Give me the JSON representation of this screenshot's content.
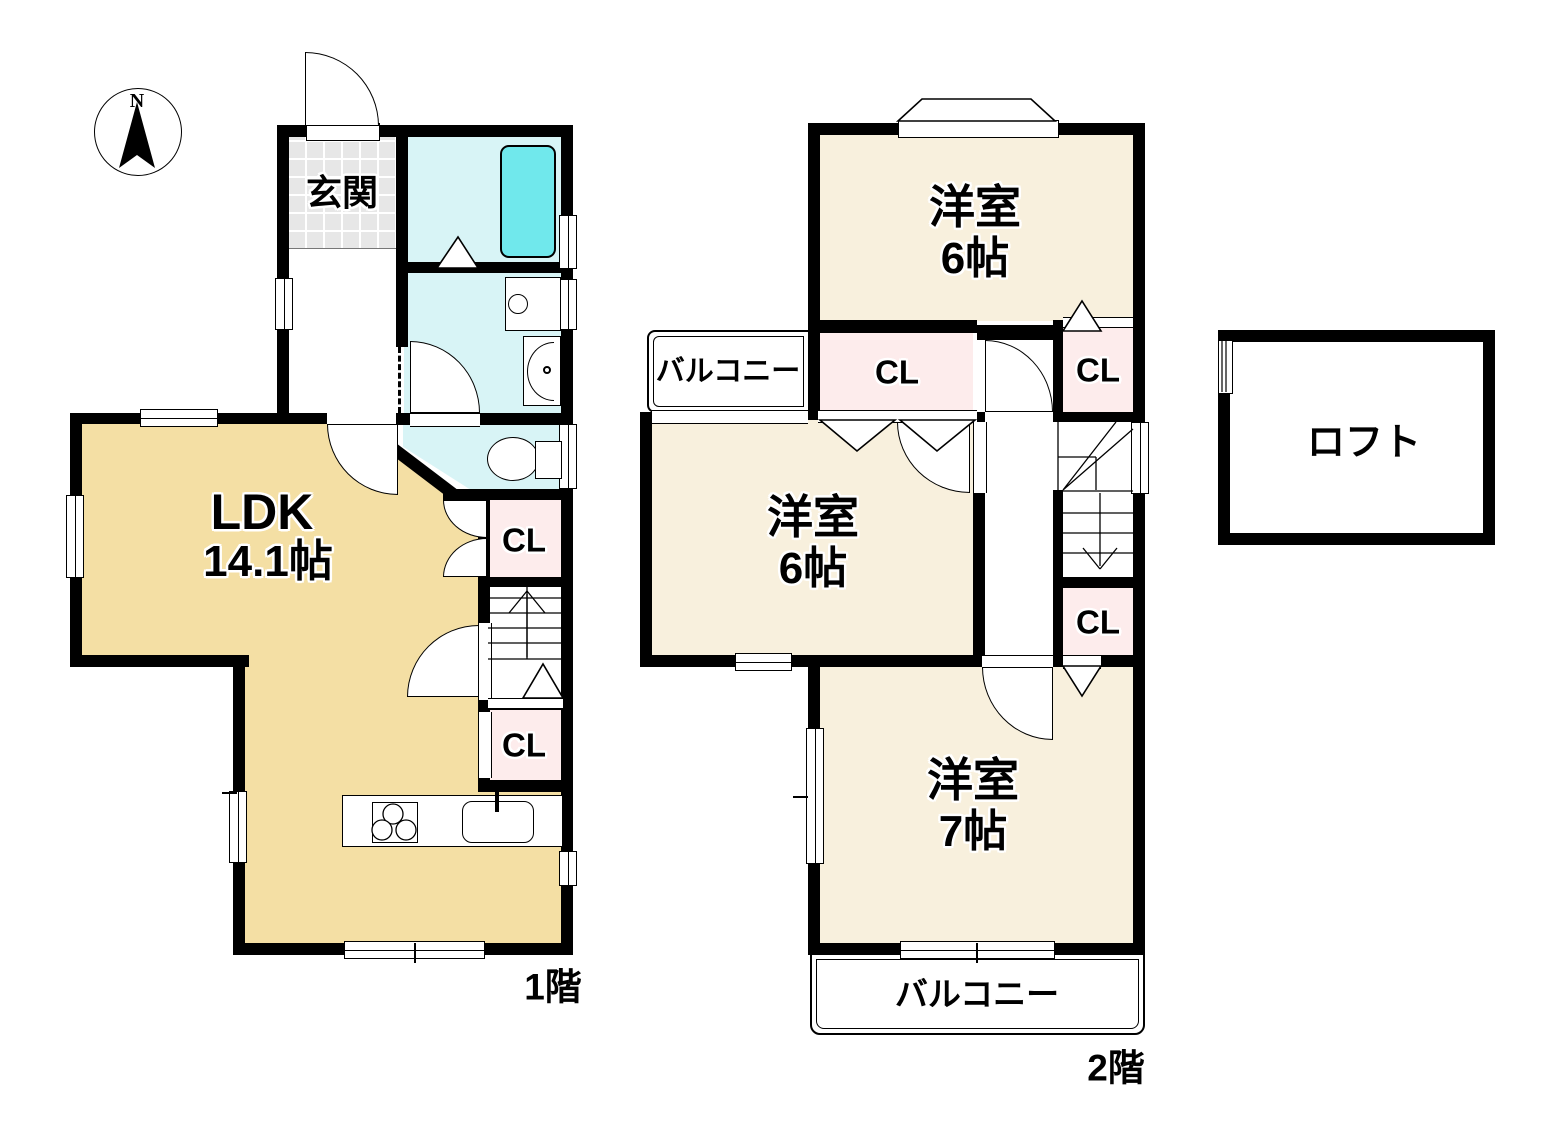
{
  "compass": {
    "north_label": "N"
  },
  "floor1": {
    "floor_label": "1階",
    "genkan_label": "玄関",
    "ldk_label": "LDK",
    "ldk_size": "14.1帖",
    "closet_upper": "CL",
    "closet_lower": "CL"
  },
  "floor2": {
    "floor_label": "2階",
    "room_north_label": "洋室",
    "room_north_size": "6帖",
    "room_middle_label": "洋室",
    "room_middle_size": "6帖",
    "room_south_label": "洋室",
    "room_south_size": "7帖",
    "closet_west": "CL",
    "closet_east_upper": "CL",
    "closet_east_lower": "CL",
    "balcony_west_label": "バルコニー",
    "balcony_south_label": "バルコニー"
  },
  "loft": {
    "label": "ロフト"
  },
  "colors": {
    "wall": "#000000",
    "ldk_floor": "#f4dfa4",
    "bedroom_floor": "#f8f0dd",
    "wet_area_floor": "#d8f4f6",
    "bathtub": "#70e8ec",
    "closet": "#fdecec",
    "genkan_tile": "#e7e7e7"
  }
}
